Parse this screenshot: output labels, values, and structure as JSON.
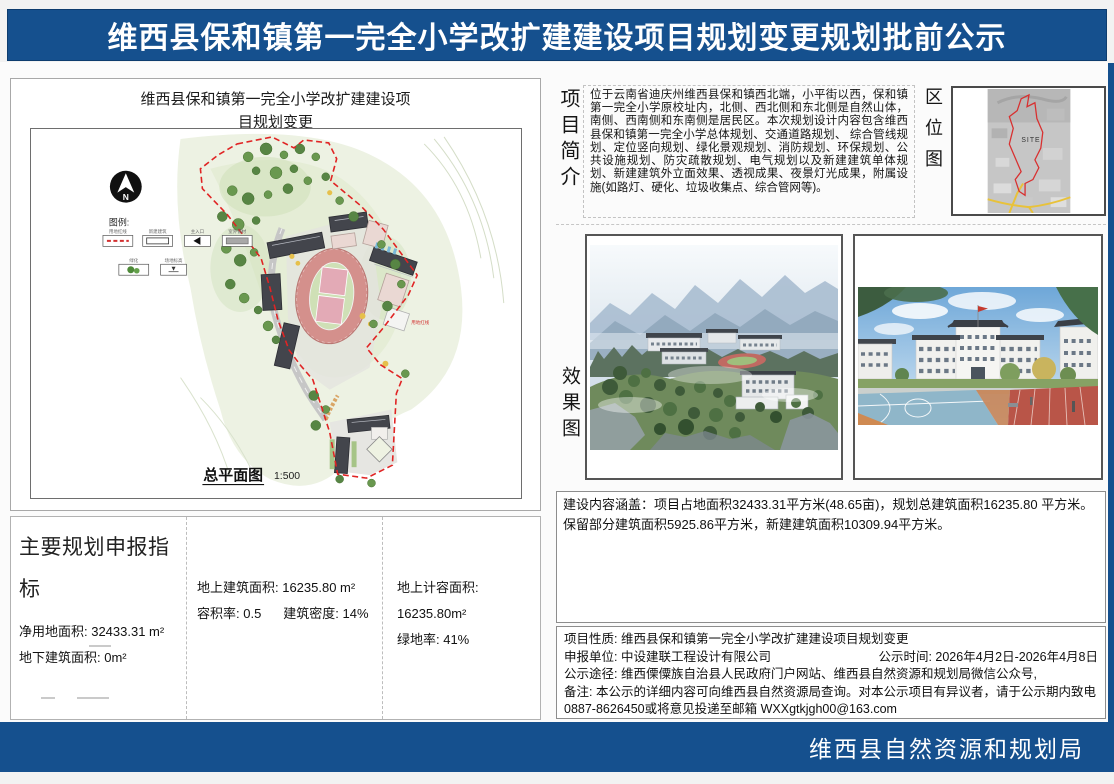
{
  "header": {
    "title": "维西县保和镇第一完全小学改扩建建设项目规划变更规划批前公示"
  },
  "footer": {
    "agency": "维西县自然资源和规划局"
  },
  "colors": {
    "accent_blue": "#15508E",
    "boundary_red": "#E02424"
  },
  "site_plan": {
    "title_line1": "维西县保和镇第一完全小学改扩建建设项",
    "title_line2": "目规划变更",
    "north_label": "N",
    "legend_title": "图例:",
    "legend_items": [
      "用地红线",
      "新建建筑",
      "主入口",
      "室外铺材",
      "绿化",
      "场地标高"
    ],
    "caption": "总平面图",
    "scale": "1:500"
  },
  "indicators": {
    "title": "主要规划申报指标",
    "net_land_area": "净用地面积: 32433.31 m²",
    "underground_area": "地下建筑面积: 0m²",
    "above_ground_area": "地上建筑面积: 16235.80 m²",
    "far": "容积率: 0.5",
    "density": "建筑密度: 14%",
    "countable_area": "地上计容面积: 16235.80m²",
    "green_ratio": "绿地率: 41%"
  },
  "project_intro": {
    "label": "项目简介",
    "text": "位于云南省迪庆州维西县保和镇西北端，小平街以西，保和镇第一完全小学原校址内，北侧、西北侧和东北侧是自然山体，南侧、西南侧和东南侧是居民区。本次规划设计内容包含维西县保和镇第一完全小学总体规划、交通道路规划、 综合管线规划、定位竖向规划、绿化景观规划、消防规划、环保规划、公共设施规划、防灾疏散规划、电气规划以及新建建筑单体规划、新建建筑外立面效果、透视成果、夜景灯光成果，附属设施(如路灯、硬化、垃圾收集点、综合管网等)。"
  },
  "location_map": {
    "label": "区位图",
    "site_text": "SITE"
  },
  "renderings": {
    "label": "效果图"
  },
  "construction_summary": {
    "text": "建设内容涵盖：项目占地面积32433.31平方米(48.65亩)，规划总建筑面积16235.80 平方米。保留部分建筑面积5925.86平方米，新建建筑面积10309.94平方米。"
  },
  "notice_info": {
    "nature": "项目性质: 维西县保和镇第一完全小学改扩建建设项目规划变更",
    "applicant": "申报单位: 中设建联工程设计有限公司",
    "publicity_time": "公示时间: 2026年4月2日-2026年4月8日",
    "channels": "公示途径: 维西傈僳族自治县人民政府门户网站、维西县自然资源和规划局微信公众号,",
    "remark": "备注: 本公示的详细内容可向维西县自然资源局查询。对本公示项目有异议者，请于公示期内致电0887-8626450或将意见投递至邮箱 WXXgtkjgh00@163.com"
  }
}
